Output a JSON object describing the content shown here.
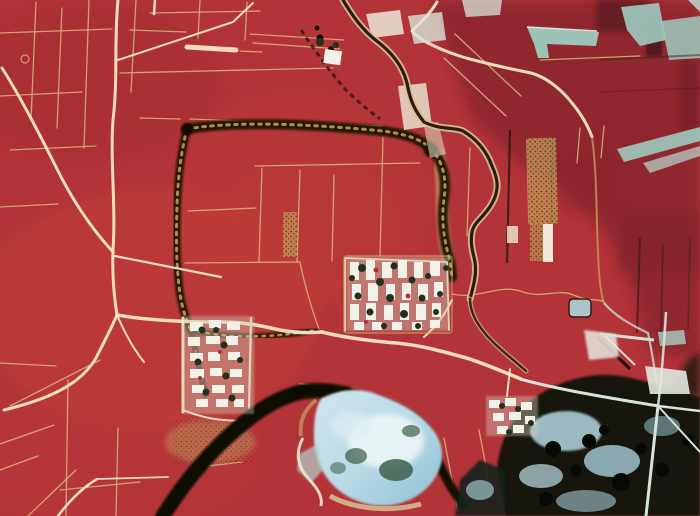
{
  "image": {
    "kind": "False-color infrared aerial photograph",
    "scene": "Remote-sensing image of an agricultural plain: bright red cropland criss-crossed by pale field roads, the dark rectangular earthwork of a buried ancient city wall, white village house clusters, a meandering tree-lined river, a black water channel, a pale blue lake and dark wooded wetland in the lower right, and cyan fallow fields in the upper right.",
    "width_px": 700,
    "height_px": 516
  },
  "palette": {
    "field_red": "#b23338",
    "field_red_bright": "#c44239",
    "field_red_deep": "#8d272e",
    "maroon_dark": "#5e1e22",
    "boundary_tan": "#d7b67c",
    "road_cream": "#f1e6c4",
    "wall_dark": "#1d1206",
    "wall_tan": "#c9a25c",
    "river_dark": "#231307",
    "river_bank": "#d8c194",
    "water_black": "#0b0805",
    "lake_blue": "#aed3e0",
    "lake_highlight": "#ecf5f6",
    "lake_teal": "#40604e",
    "cyan_field": "#9ecabe",
    "forest_dark": "#121409",
    "marsh_blue": "#a9ccd4",
    "village_white": "#f2f1e8",
    "village_tree": "#22301c"
  },
  "features": [
    {
      "name": "red-farmland",
      "label": "Vegetated cropland (bright red in false-color IR)"
    },
    {
      "name": "ancient-walled-enclosure",
      "label": "Dark rectangular outline of ancient city-wall earthwork"
    },
    {
      "name": "field-roads",
      "label": "Pale cream roads and tan parcel boundary lines"
    },
    {
      "name": "meandering-river",
      "label": "Tree-lined meandering river with sandy banks, east side"
    },
    {
      "name": "dark-river-channel",
      "label": "Black water channel crossing the lower left"
    },
    {
      "name": "lake",
      "label": "Pale blue lake with white silt highlight, bottom center"
    },
    {
      "name": "wetland-woodland",
      "label": "Dark wooded wetland with blue water patches, lower right"
    },
    {
      "name": "main-village",
      "label": "Main village: white courtyard houses with dark tree canopies"
    },
    {
      "name": "west-village",
      "label": "Western village cluster"
    },
    {
      "name": "hamlet",
      "label": "Small hamlet south-east of the main village"
    },
    {
      "name": "fallow-fields-cyan",
      "label": "Bare / fallow fields appearing cyan, upper right"
    },
    {
      "name": "orchard-plantation",
      "label": "Speckled orchard / plantation plots"
    }
  ]
}
